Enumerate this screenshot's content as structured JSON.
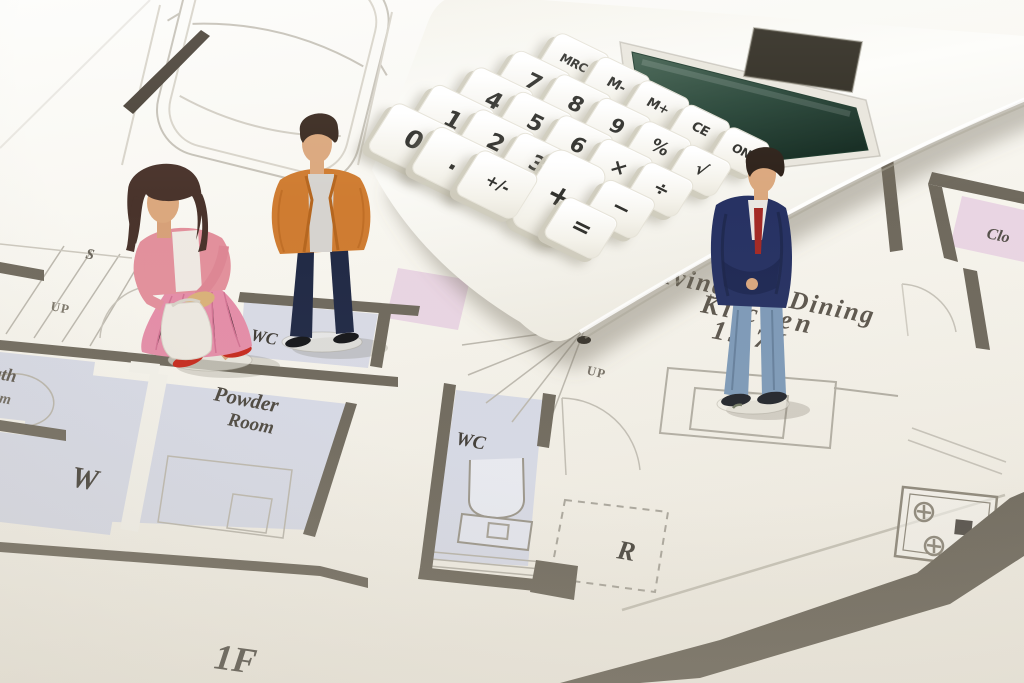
{
  "calculator": {
    "keys": [
      [
        "MRC",
        "M-",
        "M+",
        "CE",
        "ON"
      ],
      [
        "7",
        "8",
        "9",
        "%",
        "√"
      ],
      [
        "4",
        "5",
        "6",
        "×",
        "÷"
      ],
      [
        "1",
        "2",
        "3",
        "+",
        "−"
      ],
      [
        "0",
        ".",
        "+/-",
        "",
        "="
      ]
    ],
    "colors": {
      "body": "#f7f5ee",
      "display": "#1d3a2c",
      "solar": "#2f2b21",
      "key_text": "#32322e"
    }
  },
  "floor_plan": {
    "labels": {
      "bath_line1": "Bath",
      "bath_line2": "Room",
      "s_fragment": "S",
      "up_left": "UP",
      "up_center": "UP",
      "w_room": "W",
      "powder_line1": "Powder",
      "powder_line2": "Room",
      "wc_top": "WC",
      "wc_center": "WC",
      "r_room": "R",
      "closet": "Clo",
      "ldk_line1": "Living Dining",
      "ldk_line2": "Kitchen",
      "ldk_line3": "15.7J",
      "floor": "1F"
    },
    "colors": {
      "wall": "#6f695d",
      "room_blue": "#d7dae6",
      "room_pink": "#e9d5e3",
      "line": "#b7b3a9",
      "text": "#4c473f"
    }
  },
  "figures": {
    "woman": {
      "hair": "#49332b",
      "jacket": "#e2909c",
      "skirt": "#e48da8",
      "bag": "#ece8e0",
      "shoes": "#c62a1e",
      "skin": "#dba87e"
    },
    "man_orange": {
      "hair": "#3b2b21",
      "jacket": "#cf7c31",
      "shirt": "#d6d3cf",
      "pants": "#202945",
      "shoes": "#15161a",
      "skin": "#dba87e"
    },
    "man_navy": {
      "hair": "#2d2119",
      "jacket": "#273263",
      "tie": "#a32a26",
      "shirt": "#e9e6e1",
      "pants": "#7e9ab8",
      "shoes": "#23262c",
      "skin": "#dba87e"
    }
  }
}
